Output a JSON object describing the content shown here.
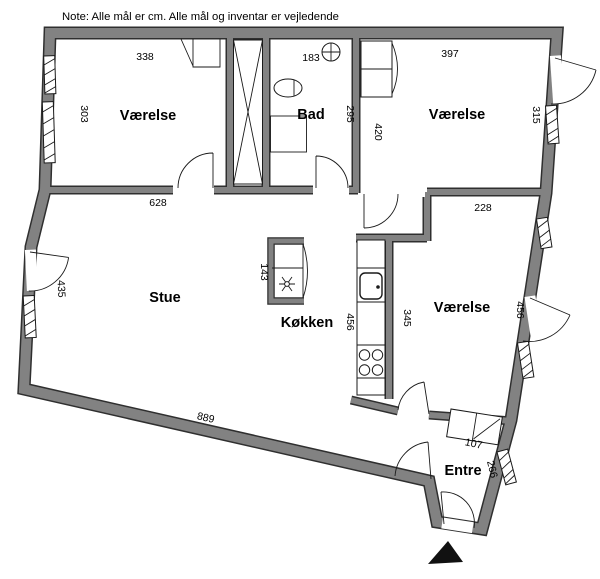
{
  "note": "Note: Alle mål er cm. Alle mål og inventar er vejledende",
  "rooms": {
    "bedroom_nw": "Værelse",
    "bath": "Bad",
    "bedroom_ne": "Værelse",
    "living": "Stue",
    "kitchen": "Køkken",
    "bedroom_e": "Værelse",
    "entry": "Entre"
  },
  "dims": {
    "bedroom_nw_width": "338",
    "bedroom_nw_depth": "303",
    "bath_width": "183",
    "bath_depth": "295",
    "bedroom_ne_width": "397",
    "bedroom_ne_depth_left": "420",
    "bedroom_ne_depth_right": "315",
    "living_top": "628",
    "living_left": "435",
    "living_bottom": "889",
    "kitchen_island": "143",
    "kitchen_counter": "456",
    "bedroom_e_top": "228",
    "bedroom_e_left": "345",
    "bedroom_e_right": "456",
    "entry_wardrobe": "107",
    "entry_side": "266"
  },
  "colors": {
    "wall_fill": "#828282",
    "wall_edge": "#2f2f2f",
    "background": "#ffffff",
    "marker": "#111111"
  }
}
